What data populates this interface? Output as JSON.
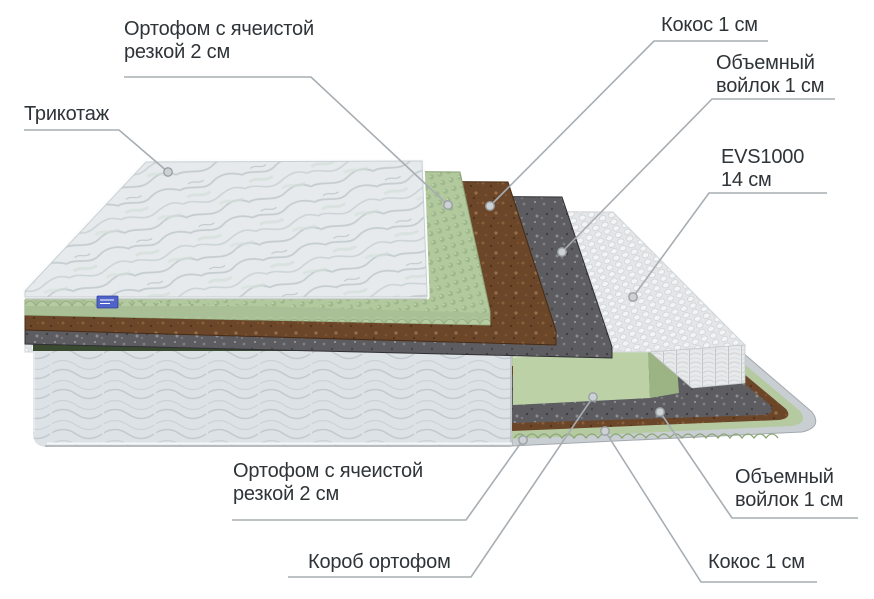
{
  "callouts": {
    "trikotazh": {
      "text": "Трикотаж"
    },
    "ortofom_top": {
      "text": "Ортофом с ячеистой\nрезкой 2 см"
    },
    "kokos_top": {
      "text": "Кокос 1 см"
    },
    "voilok_top": {
      "text": "Объемный\nвойлок 1 см"
    },
    "evs": {
      "text": "EVS1000\n14 см"
    },
    "ortofom_bottom": {
      "text": "Ортофом с ячеистой\nрезкой 2 см"
    },
    "korob": {
      "text": "Короб ортофом"
    },
    "voilok_bottom": {
      "text": "Объемный\nвойлок 1 см"
    },
    "kokos_bottom": {
      "text": "Кокос 1 см"
    }
  },
  "diagram": {
    "type": "mattress-layers-cutaway",
    "layers": [
      {
        "name": "Трикотаж",
        "color": "#e7ebed"
      },
      {
        "name": "Ортофом с ячеистой резкой 2 см",
        "color": "#b2c89d"
      },
      {
        "name": "Кокос 1 см",
        "color": "#6b4629"
      },
      {
        "name": "Объемный войлок 1 см",
        "color": "#5d5d61"
      },
      {
        "name": "EVS1000 14 см",
        "color": "#e9ebec"
      },
      {
        "name": "Короб ортофом",
        "color": "#bcd2a6"
      }
    ],
    "leader_color": "#a7adb2",
    "text_color": "#2f3438",
    "background": "#ffffff",
    "tag_color": "#5063c8"
  }
}
